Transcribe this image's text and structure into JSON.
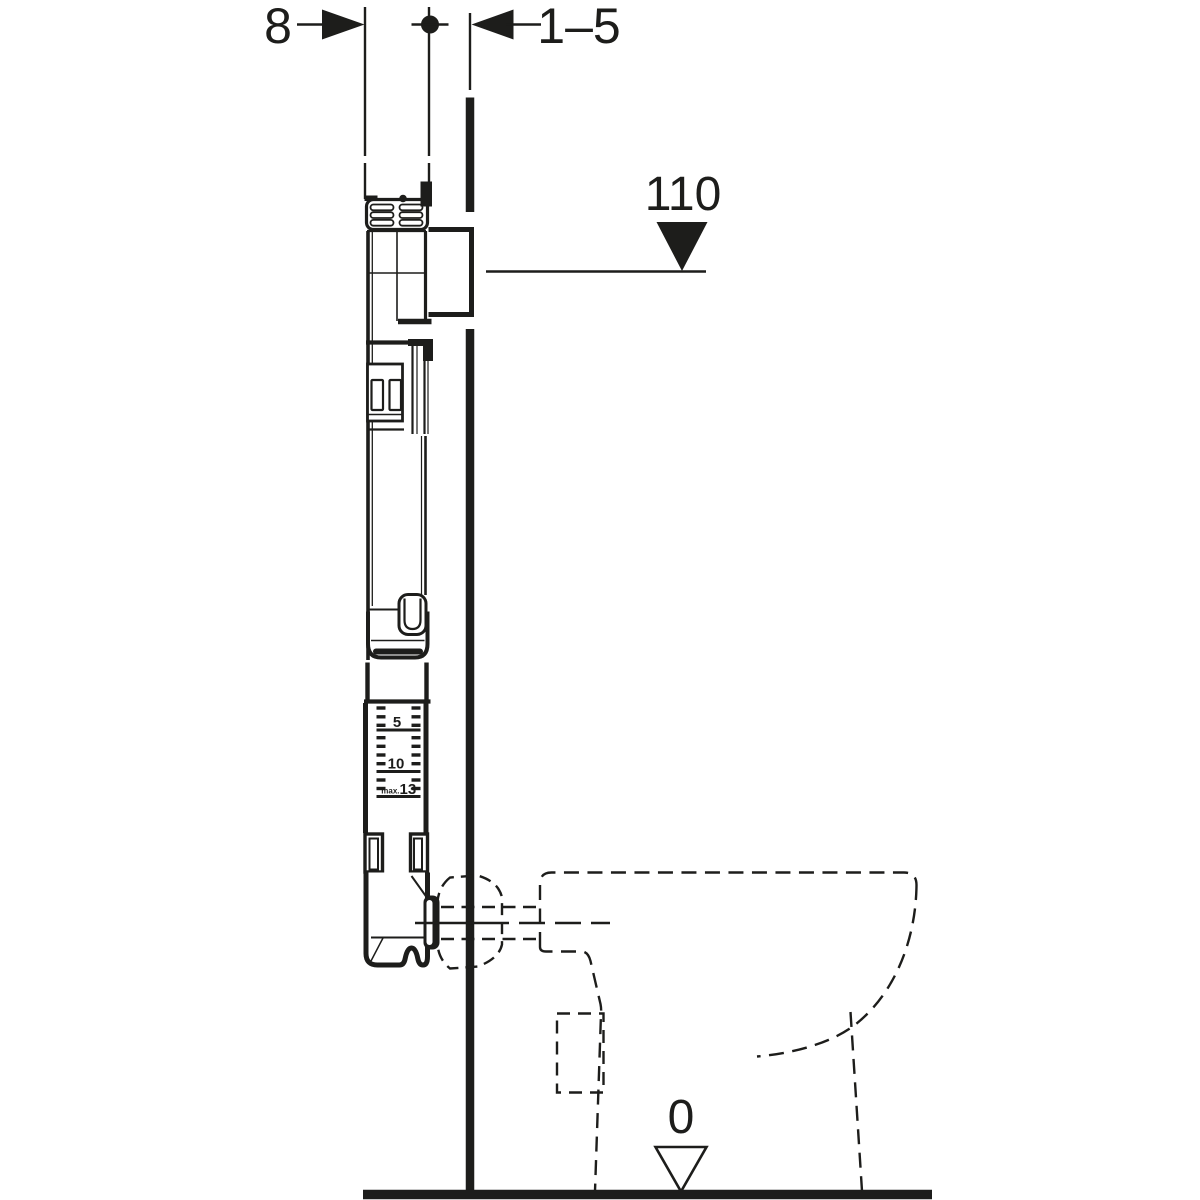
{
  "diagram": {
    "type": "technical installation drawing, concealed cistern with wall-hung frame and floor-standing WC (side section)",
    "background_color": "#ffffff",
    "line_color": "#1d1d1b",
    "dimension_labels": {
      "frame_depth": "8",
      "wall_finish_distance": "1–5",
      "actuation_height": "110",
      "floor_level": "0"
    },
    "depth_gauge": {
      "label_5": "5",
      "label_10": "10",
      "label_max_prefix": "max.",
      "label_13": "13"
    }
  }
}
